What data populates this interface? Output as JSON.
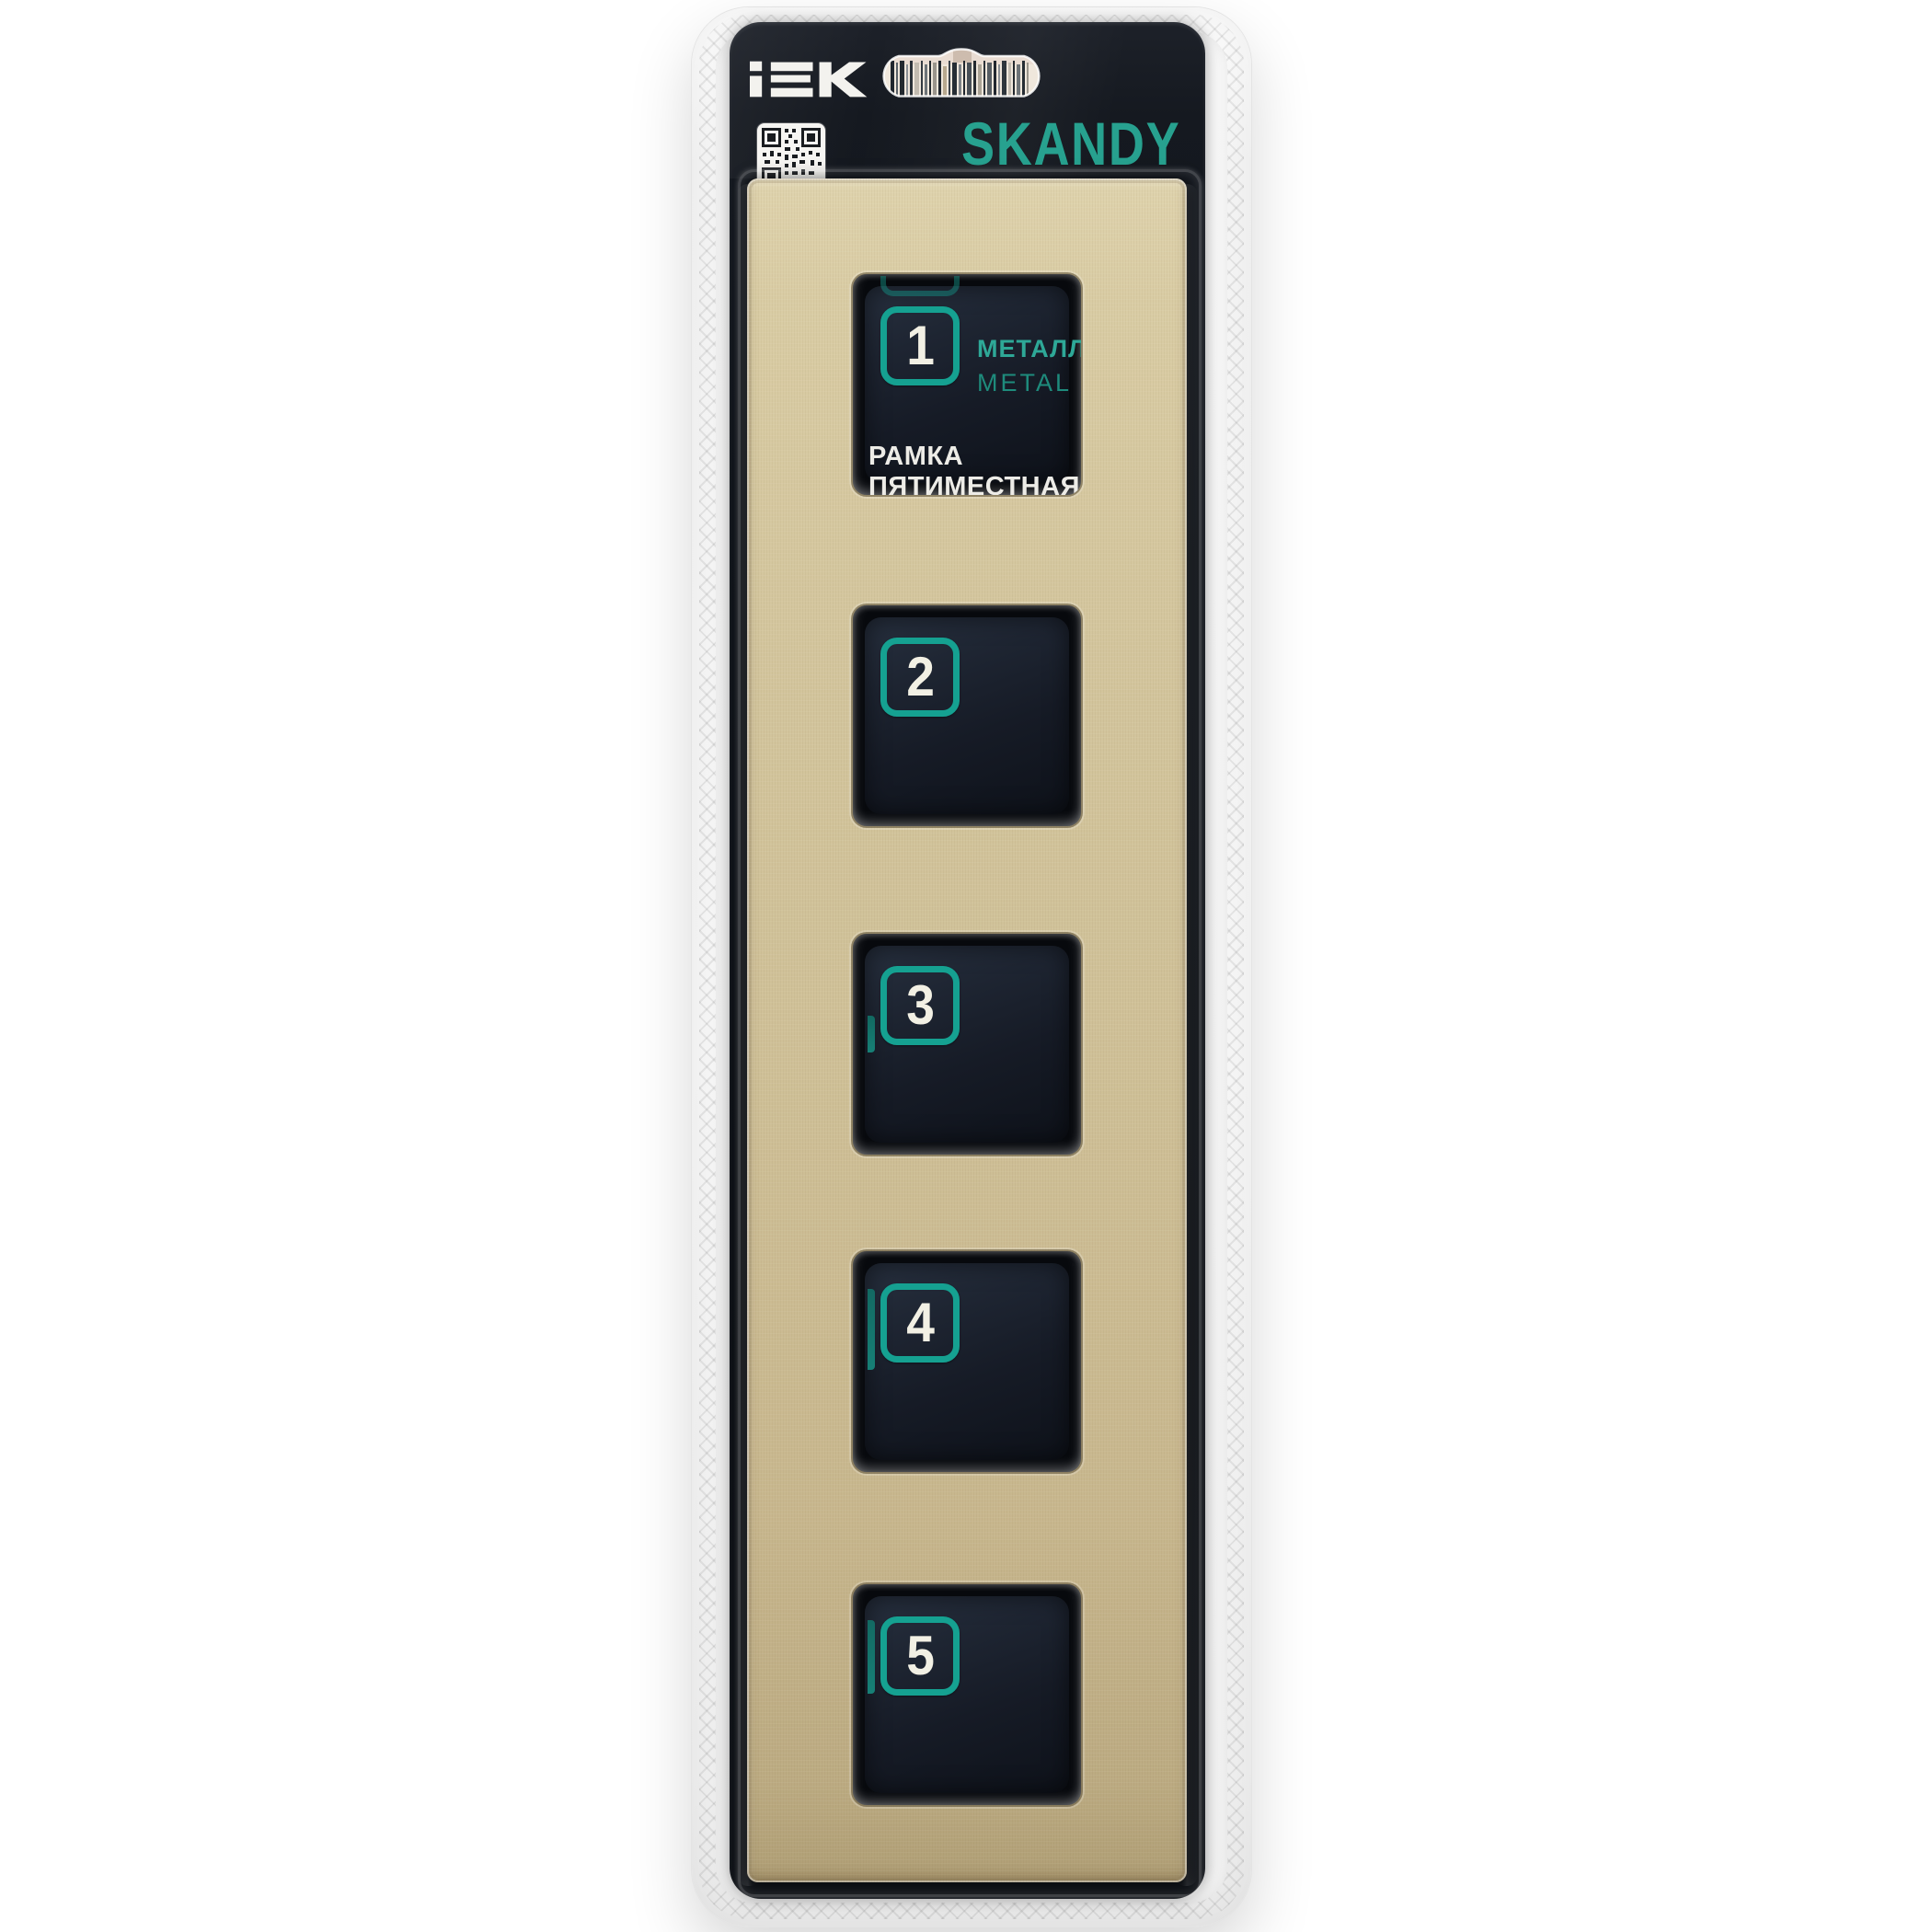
{
  "header": {
    "brand": "iEK",
    "series": "SKANDY",
    "website": "iek.ru"
  },
  "product_label": {
    "material_ru": "МЕТАЛЛ",
    "material_en": "METAL",
    "name_line1": "РАМКА",
    "name_line2": "ПЯТИМЕСТНАЯ"
  },
  "windows": [
    {
      "number": "1"
    },
    {
      "number": "2"
    },
    {
      "number": "3"
    },
    {
      "number": "4"
    },
    {
      "number": "5"
    }
  ],
  "icons": {
    "qr_code": "qr-code",
    "hang_hole": "euro-hang-slot",
    "barcode": "barcode"
  },
  "colors": {
    "teal_accent": "#27a18f",
    "badge_teal": "#15a191",
    "gold_frame": "#d3c59d",
    "card_black": "#10141a",
    "text_white": "#edece7"
  }
}
